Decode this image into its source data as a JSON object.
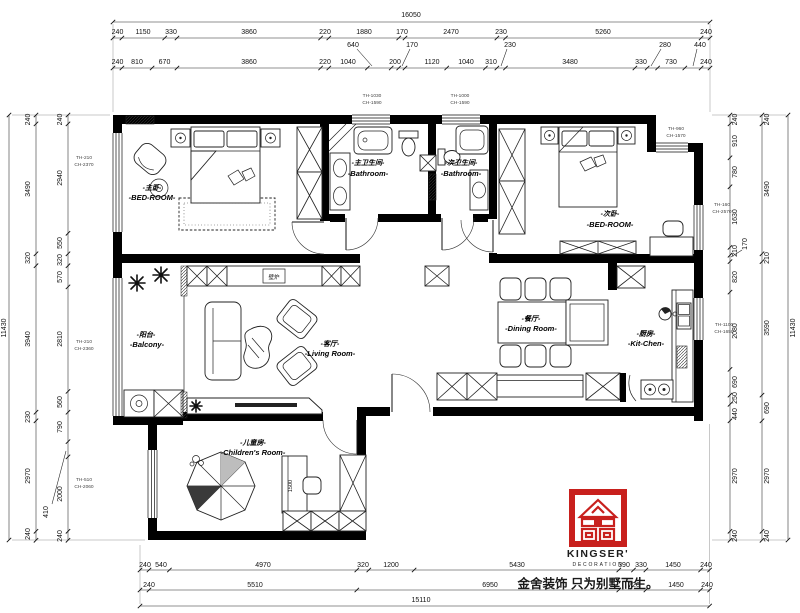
{
  "brand": {
    "name": "KINGSER'",
    "subtitle": "DECORATION",
    "slogan": "金舍装饰 只为别墅而生。"
  },
  "rooms": {
    "master_bedroom": {
      "cn": "-主卧-",
      "en": "-BED-ROOM-"
    },
    "master_bathroom": {
      "cn": "-主卫生间-",
      "en": "-Bathroom-"
    },
    "second_bathroom": {
      "cn": "-次卫生间-",
      "en": "-Bathroom-"
    },
    "second_bedroom": {
      "cn": "-次卧-",
      "en": "-BED-ROOM-"
    },
    "balcony": {
      "cn": "-阳台-",
      "en": "-Balcony-"
    },
    "living_room": {
      "cn": "-客厅-",
      "en": "-Living Room-"
    },
    "dining_room": {
      "cn": "-餐厅-",
      "en": "-Dining Room-"
    },
    "kitchen": {
      "cn": "-厨房-",
      "en": "-Kit-Chen-"
    },
    "childrens_room": {
      "cn": "-儿童房-",
      "en": "-Children's Room-"
    }
  },
  "labels": {
    "fireplace": "壁炉",
    "desk_width": "1500"
  },
  "window_notes": {
    "left_top": {
      "l1": "TH-210",
      "l2": "CH-2370"
    },
    "left_mid": {
      "l1": "TH-210",
      "l2": "CH-2360"
    },
    "left_bottom": {
      "l1": "TH-510",
      "l2": "CH-2060"
    },
    "top_master_bath": {
      "l1": "TH-1030",
      "l2": "CH-1590"
    },
    "top_second_bath": {
      "l1": "TH-1000",
      "l2": "CH-1590"
    },
    "right_top": {
      "l1": "TH-960",
      "l2": "CH-1570"
    },
    "right_mid": {
      "l1": "TH-160",
      "l2": "CH-2570"
    },
    "right_kitchen": {
      "l1": "TH-1100",
      "l2": "CH-1650"
    }
  },
  "dims": {
    "top_total": "16050",
    "top_row2": [
      "240",
      "1150",
      "330",
      "3860",
      "220",
      "1880",
      "170",
      "2470",
      "230",
      "5260",
      "240"
    ],
    "top_row3": [
      "240",
      "810",
      "670",
      "3860",
      "220",
      "1040",
      "200",
      "1120",
      "1040",
      "310",
      "3480",
      "330",
      "730",
      "240"
    ],
    "top_leaders": [
      "640",
      "170",
      "230",
      "280",
      "440"
    ],
    "bottom_row1": [
      "240",
      "540",
      "4970",
      "320",
      "1200",
      "5430",
      "390",
      "330",
      "1450",
      "240"
    ],
    "bottom_row2": [
      "240",
      "5510",
      "6950",
      "720",
      "1450",
      "240"
    ],
    "bottom_total": "15110",
    "left_total": "11430",
    "left_outer": [
      "240",
      "3490",
      "320",
      "3940",
      "230",
      "2970",
      "240"
    ],
    "left_inner": [
      "240",
      "2940",
      "550",
      "320",
      "570",
      "2810",
      "560",
      "790",
      "2000",
      "240"
    ],
    "left_leader": "410",
    "right_total": "11430",
    "right_outer": [
      "240",
      "3490",
      "210",
      "3590",
      "690",
      "2970",
      "240"
    ],
    "right_inner": [
      "240",
      "910",
      "780",
      "1630",
      "210",
      "820",
      "2080",
      "690",
      "250",
      "440",
      "2970",
      "240"
    ],
    "right_leader": "170"
  }
}
